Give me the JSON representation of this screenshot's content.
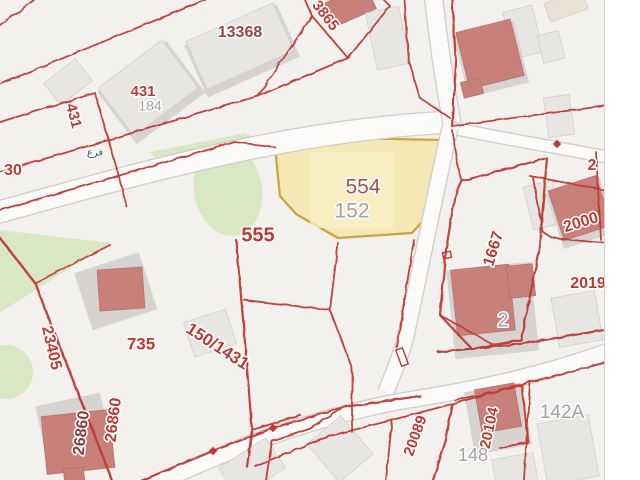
{
  "map": {
    "background": "#f2f1ee",
    "map_right_edge": 604,
    "colors": {
      "boundary_red": "#bf3a31",
      "road_fill": "#fcfbfa",
      "road_casing": "#cfccc9",
      "green_area": "#d9e7c5",
      "building_gray": "#e8e6e3",
      "building_base": "#d6d3d0",
      "building_salmon": "#c8807b",
      "building_beige": "#eae2d4",
      "highlight_fill": "#f6e8b6",
      "highlight_inner": "#f9efc8",
      "highlight_stroke": "#c9a53d",
      "label_red": "#bb3b33",
      "label_darkred": "#9c4340",
      "label_maroon": "#8a3c37",
      "label_brown": "#a1544b",
      "label_gray": "#9da2a3",
      "label_arabic": "#4d4d4d"
    },
    "highlight_parcel": {
      "name": "554",
      "points": "275,147 340,138 444,140 438,204 412,233 338,238 296,214 280,196",
      "inner_rect": {
        "x": 310,
        "y": 152,
        "w": 84,
        "h": 76
      }
    },
    "greens": [
      {
        "type": "poly",
        "points": "150,152 245,133 258,140 160,163"
      },
      {
        "type": "ellipse",
        "cx": 228,
        "cy": 190,
        "rx": 34,
        "ry": 46,
        "rot": -10
      },
      {
        "type": "poly",
        "points": "0,230 112,243 70,268 20,300 0,312"
      },
      {
        "type": "ellipse",
        "cx": 6,
        "cy": 372,
        "rx": 27,
        "ry": 27,
        "rot": 0
      }
    ],
    "roads": [
      {
        "name": "road-main-northwest",
        "d": "M-8,214 C150,170 300,128 456,122",
        "w": 21
      },
      {
        "name": "road-north",
        "d": "M452,124 C444,80 438,40 433,-8",
        "w": 17
      },
      {
        "name": "road-east",
        "d": "M452,128 C500,138 560,148 612,158",
        "w": 11
      },
      {
        "name": "road-south-center",
        "d": "M450,128 C436,190 420,270 406,336 C402,352 396,366 386,392",
        "w": 15
      },
      {
        "name": "road-southeast",
        "d": "M130,496 C230,448 320,414 420,398 C490,387 550,372 612,350",
        "w": 15
      }
    ],
    "boundaries": [
      {
        "d": "M0,25 L34,0"
      },
      {
        "d": "M0,84 L205,0"
      },
      {
        "d": "M0,122 L95,93 L120,180 L127,207"
      },
      {
        "d": "M0,172 L190,116 L258,96"
      },
      {
        "d": "M258,96 L312,16 L305,0"
      },
      {
        "d": "M312,16 L348,58 L390,6 L384,0"
      },
      {
        "d": "M348,58 L258,96"
      },
      {
        "d": "M0,210 L235,142 L275,147"
      },
      {
        "d": "M404,0 L409,62 L420,98 L450,118"
      },
      {
        "d": "M452,0 L456,64 L452,126",
        "w": 2.2
      },
      {
        "d": "M452,126 L604,106"
      },
      {
        "d": "M452,130 L458,168 L462,181"
      },
      {
        "d": "M462,181 L547,158 L539,252 L521,340 L472,349 L440,315 L446,250 L455,196 Z",
        "w": 2.2
      },
      {
        "d": "M440,315 L492,344"
      },
      {
        "d": "M414,240 L404,302 L397,348"
      },
      {
        "d": "M530,176 L604,190"
      },
      {
        "d": "M533,178 L543,232 L552,238 L604,243"
      },
      {
        "d": "M596,152 L601,240"
      },
      {
        "d": "M138,482 L213,451 L273,428 L344,407 L420,396",
        "w": 2.2
      },
      {
        "d": "M255,466 L330,436 L392,420 L452,404 L530,382 L604,363"
      },
      {
        "d": "M392,421 L386,480"
      },
      {
        "d": "M452,404 L446,440 L433,480",
        "w": 2.2
      },
      {
        "d": "M530,382 L524,480"
      },
      {
        "d": "M455,400 L522,386 L528,442 L500,448"
      },
      {
        "d": "M310,428 L272,441 L266,480"
      },
      {
        "d": "M344,407 L310,428"
      },
      {
        "d": "M35,283 L110,245"
      },
      {
        "d": "M0,238 L35,283 L112,480",
        "w": 2.4
      },
      {
        "d": "M236,240 L244,330 L252,430 L247,467",
        "w": 2.2
      },
      {
        "d": "M244,300 L330,310 L352,368 L352,432"
      },
      {
        "d": "M330,310 L338,243"
      },
      {
        "d": "M252,430 L300,415"
      },
      {
        "d": "M438,352 L520,344 L604,330",
        "w": 2.2
      }
    ],
    "buildings": [
      {
        "cx": 68,
        "cy": 82,
        "w": 40,
        "h": 28,
        "rot": -38,
        "fill": "gray"
      },
      {
        "cx": 148,
        "cy": 88,
        "w": 80,
        "h": 60,
        "rot": -37,
        "fill": "gray",
        "base": true
      },
      {
        "cx": 240,
        "cy": 46,
        "w": 95,
        "h": 52,
        "rot": -24,
        "fill": "gray",
        "base": true
      },
      {
        "cx": 350,
        "cy": 6,
        "w": 46,
        "h": 26,
        "rot": -24,
        "fill": "salmon"
      },
      {
        "cx": 388,
        "cy": 38,
        "w": 34,
        "h": 58,
        "rot": -12,
        "fill": "gray"
      },
      {
        "cx": 523,
        "cy": 32,
        "w": 30,
        "h": 48,
        "rot": -14,
        "fill": "gray"
      },
      {
        "cx": 566,
        "cy": 6,
        "w": 40,
        "h": 20,
        "rot": -20,
        "fill": "beige"
      },
      {
        "cx": 551,
        "cy": 47,
        "w": 22,
        "h": 28,
        "rot": -14,
        "fill": "gray"
      },
      {
        "cx": 559,
        "cy": 116,
        "w": 26,
        "h": 40,
        "rot": -8,
        "fill": "gray"
      },
      {
        "cx": 490,
        "cy": 54,
        "w": 56,
        "h": 58,
        "rot": -14,
        "fill": "salmon",
        "base": true
      },
      {
        "cx": 472,
        "cy": 88,
        "w": 20,
        "h": 16,
        "rot": -14,
        "fill": "salmon"
      },
      {
        "cx": 543,
        "cy": 205,
        "w": 30,
        "h": 44,
        "rot": -14,
        "fill": "gray"
      },
      {
        "cx": 580,
        "cy": 208,
        "w": 50,
        "h": 52,
        "rot": -18,
        "fill": "salmon",
        "base": true
      },
      {
        "cx": 577,
        "cy": 319,
        "w": 44,
        "h": 50,
        "rot": -10,
        "fill": "gray"
      },
      {
        "cx": 492,
        "cy": 305,
        "w": 78,
        "h": 84,
        "rot": -6,
        "fill": "base-only"
      },
      {
        "cx": 483,
        "cy": 300,
        "w": 58,
        "h": 66,
        "rot": -6,
        "fill": "salmon"
      },
      {
        "cx": 521,
        "cy": 281,
        "w": 26,
        "h": 32,
        "rot": -6,
        "fill": "salmon"
      },
      {
        "cx": 114,
        "cy": 286,
        "w": 62,
        "h": 55,
        "rot": -18,
        "fill": "base-only"
      },
      {
        "cx": 121,
        "cy": 289,
        "w": 45,
        "h": 41,
        "rot": -4,
        "fill": "salmon"
      },
      {
        "cx": 210,
        "cy": 333,
        "w": 44,
        "h": 36,
        "rot": -18,
        "fill": "gray"
      },
      {
        "cx": 72,
        "cy": 420,
        "w": 60,
        "h": 48,
        "rot": -12,
        "fill": "base-only"
      },
      {
        "cx": 78,
        "cy": 442,
        "w": 68,
        "h": 58,
        "rot": -6,
        "fill": "salmon"
      },
      {
        "cx": 74,
        "cy": 475,
        "w": 20,
        "h": 14,
        "rot": -6,
        "fill": "salmon"
      },
      {
        "cx": 340,
        "cy": 449,
        "w": 44,
        "h": 50,
        "rot": -40,
        "fill": "gray"
      },
      {
        "cx": 252,
        "cy": 468,
        "w": 56,
        "h": 36,
        "rot": -33,
        "fill": "gray"
      },
      {
        "cx": 497,
        "cy": 413,
        "w": 52,
        "h": 58,
        "rot": -10,
        "fill": "base-only"
      },
      {
        "cx": 498,
        "cy": 408,
        "w": 40,
        "h": 44,
        "rot": -10,
        "fill": "salmon"
      },
      {
        "cx": 568,
        "cy": 450,
        "w": 52,
        "h": 62,
        "rot": -10,
        "fill": "gray"
      },
      {
        "cx": 515,
        "cy": 471,
        "w": 42,
        "h": 30,
        "rot": -10,
        "fill": "gray"
      }
    ],
    "markers": {
      "diamonds": [
        {
          "x": 213,
          "y": 451
        },
        {
          "x": 273,
          "y": 428
        },
        {
          "x": 557,
          "y": 144
        }
      ],
      "white_rect": {
        "x": 402,
        "y": 357,
        "w": 17,
        "h": 7,
        "rot": 70
      },
      "red_rect": {
        "x": 447,
        "y": 255,
        "w": 8,
        "h": 6,
        "rot": -10
      }
    },
    "labels": [
      {
        "text": "13368",
        "x": 240,
        "y": 33,
        "rot": 0,
        "color": "darkred",
        "size": 16,
        "bold": true
      },
      {
        "text": "431",
        "x": 143,
        "y": 92,
        "rot": 0,
        "color": "red",
        "size": 15,
        "bold": true
      },
      {
        "text": "184",
        "x": 150,
        "y": 107,
        "rot": 0,
        "color": "gray",
        "size": 14,
        "bold": false
      },
      {
        "text": "431",
        "x": 73,
        "y": 116,
        "rot": 75,
        "color": "red",
        "size": 15,
        "bold": true
      },
      {
        "text": "3865",
        "x": 325,
        "y": 16,
        "rot": 52,
        "color": "red",
        "size": 15,
        "bold": true
      },
      {
        "text": "30",
        "x": 13,
        "y": 171,
        "rot": 0,
        "color": "red",
        "size": 16,
        "bold": true
      },
      {
        "text": "فرع",
        "x": 95,
        "y": 153,
        "rot": 0,
        "color": "arabic",
        "size": 10,
        "bold": false
      },
      {
        "text": "554",
        "x": 363,
        "y": 188,
        "rot": 0,
        "color": "brown",
        "size": 21,
        "bold": false
      },
      {
        "text": "152",
        "x": 352,
        "y": 212,
        "rot": 0,
        "color": "gray",
        "size": 21,
        "bold": false
      },
      {
        "text": "555",
        "x": 258,
        "y": 236,
        "rot": 0,
        "color": "red",
        "size": 20,
        "bold": true
      },
      {
        "text": "735",
        "x": 141,
        "y": 345,
        "rot": 0,
        "color": "red",
        "size": 17,
        "bold": true
      },
      {
        "text": "150/1431",
        "x": 217,
        "y": 347,
        "rot": 33,
        "color": "red",
        "size": 17,
        "bold": true
      },
      {
        "text": "23405",
        "x": 51,
        "y": 348,
        "rot": 77,
        "color": "red",
        "size": 16,
        "bold": true
      },
      {
        "text": "26860",
        "x": 82,
        "y": 433,
        "rot": -83,
        "color": "maroon",
        "size": 16,
        "bold": true
      },
      {
        "text": "26860",
        "x": 114,
        "y": 420,
        "rot": -83,
        "color": "red",
        "size": 16,
        "bold": true
      },
      {
        "text": "1667",
        "x": 494,
        "y": 249,
        "rot": -73,
        "color": "red",
        "size": 16,
        "bold": true
      },
      {
        "text": "2",
        "x": 503,
        "y": 321,
        "rot": 0,
        "color": "gray",
        "size": 20,
        "bold": false
      },
      {
        "text": "2000",
        "x": 581,
        "y": 223,
        "rot": -17,
        "color": "red",
        "size": 16,
        "bold": true
      },
      {
        "text": "2",
        "x": 592,
        "y": 166,
        "rot": 0,
        "color": "red",
        "size": 16,
        "bold": true
      },
      {
        "text": "2019",
        "x": 588,
        "y": 284,
        "rot": 0,
        "color": "red",
        "size": 16,
        "bold": true
      },
      {
        "text": "142A",
        "x": 562,
        "y": 413,
        "rot": 0,
        "color": "gray",
        "size": 19,
        "bold": false
      },
      {
        "text": "20089",
        "x": 416,
        "y": 436,
        "rot": -70,
        "color": "red",
        "size": 15,
        "bold": true
      },
      {
        "text": "20104",
        "x": 490,
        "y": 428,
        "rot": -78,
        "color": "red",
        "size": 15,
        "bold": true
      },
      {
        "text": "148",
        "x": 473,
        "y": 456,
        "rot": 0,
        "color": "gray",
        "size": 18,
        "bold": false
      }
    ]
  }
}
